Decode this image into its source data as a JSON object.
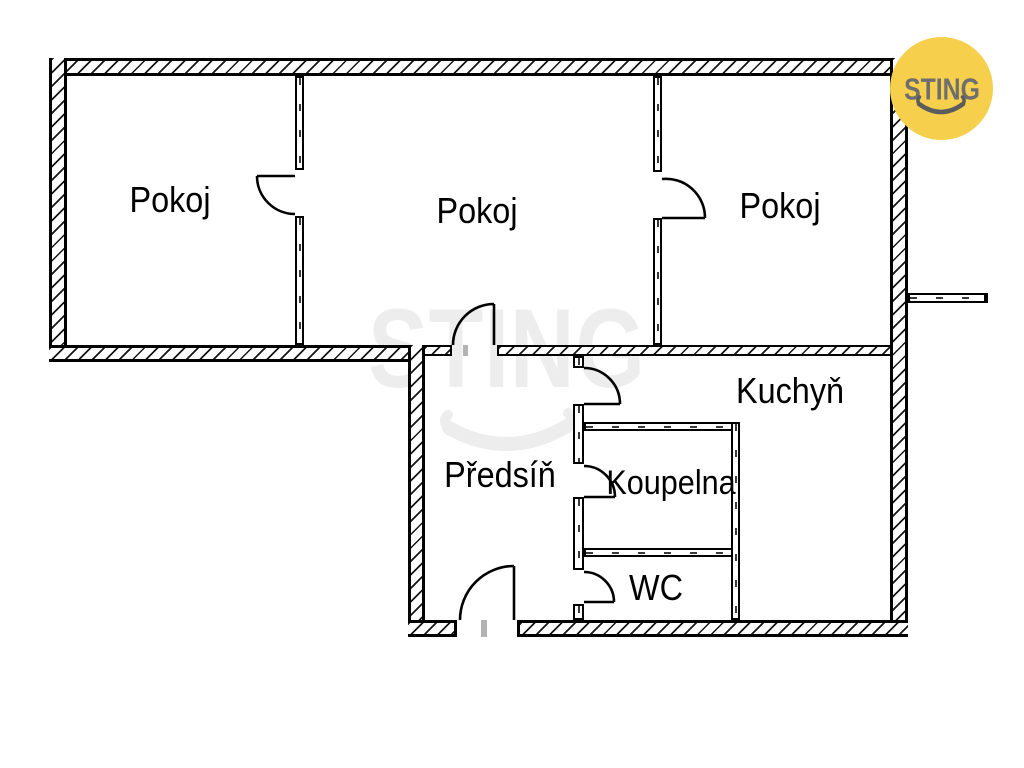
{
  "plan": {
    "rooms": [
      {
        "id": "pokoj-left",
        "label": "Pokoj"
      },
      {
        "id": "pokoj-middle",
        "label": "Pokoj"
      },
      {
        "id": "pokoj-right",
        "label": "Pokoj"
      },
      {
        "id": "kuchyn",
        "label": "Kuchyň"
      },
      {
        "id": "predsin",
        "label": "Předsíň"
      },
      {
        "id": "koupelna",
        "label": "Koupelna"
      },
      {
        "id": "wc",
        "label": "WC"
      }
    ],
    "wall_color": "#000000",
    "label_color": "#000000",
    "threshold_tick_color": "#b3b3b3"
  },
  "watermark": {
    "text": "STING",
    "color": "#ededed"
  },
  "logo": {
    "text": "STING",
    "circle_color": "#f6cf4d",
    "text_color": "#6e6e6e",
    "smile_color": "#5c5c5c"
  }
}
